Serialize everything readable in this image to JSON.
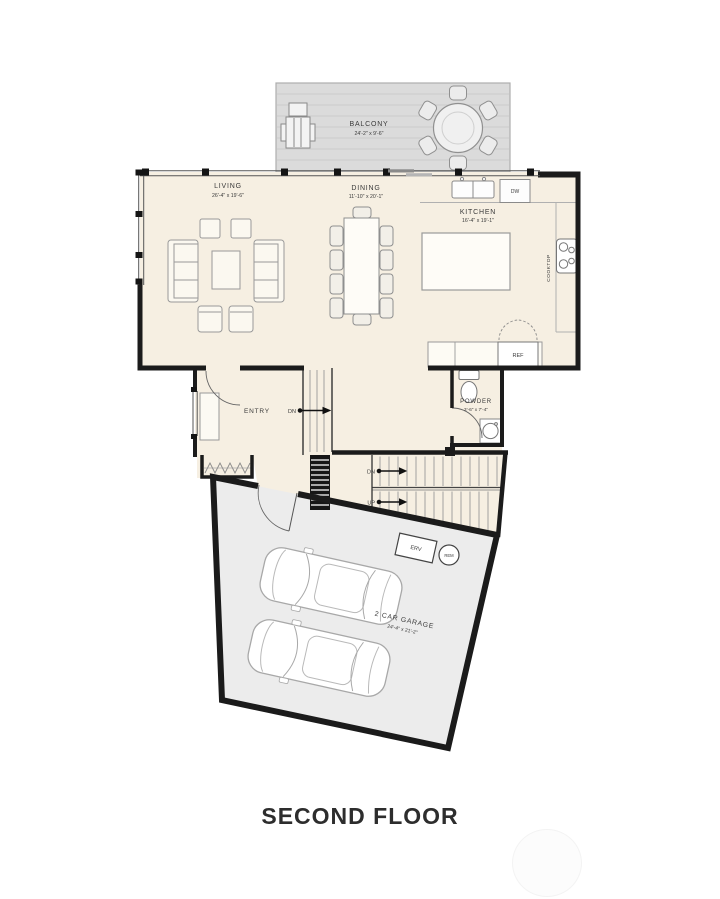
{
  "title": "SECOND FLOOR",
  "colors": {
    "wall": "#1b1b1b",
    "floor": "#f6efe2",
    "deck": "#dbdbdb",
    "garage_floor": "#ececec"
  },
  "rooms": {
    "balcony": {
      "name": "BALCONY",
      "dims": "24'-2\" x 9'-6\""
    },
    "living": {
      "name": "LIVING",
      "dims": "26'-4\" x 19'-6\""
    },
    "dining": {
      "name": "DINING",
      "dims": "11'-10\" x 20'-1\""
    },
    "kitchen": {
      "name": "KITCHEN",
      "dims": "16'-4\" x 19'-1\""
    },
    "entry": {
      "name": "ENTRY"
    },
    "powder": {
      "name": "POWDER",
      "dims": "3'-6\" x 7'-4\""
    },
    "garage": {
      "name": "2 CAR GARAGE",
      "dims": "24'-4\" x 21'-2\""
    }
  },
  "labels": {
    "dishwasher": "DW",
    "refrigerator": "REF",
    "cooktop": "COOKTOP",
    "erv": "ERV",
    "rem": "REM",
    "down": "DN",
    "up": "UP"
  }
}
